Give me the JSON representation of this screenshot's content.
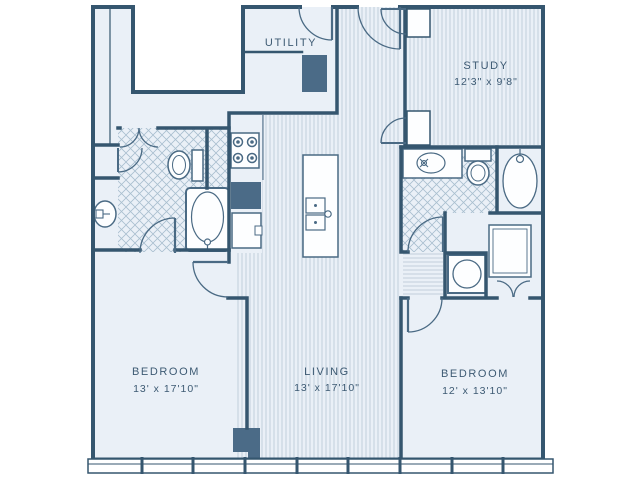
{
  "plan": {
    "rooms": {
      "utility": {
        "name": "UTILITY"
      },
      "study": {
        "name": "STUDY",
        "dims": "12'3\" x 9'8\""
      },
      "bedroom_left": {
        "name": "BEDROOM",
        "dims": "13' x 17'10\""
      },
      "living": {
        "name": "LIVING",
        "dims": "13' x 17'10\""
      },
      "bedroom_right": {
        "name": "BEDROOM",
        "dims": "12' x 13'10\""
      }
    },
    "colors": {
      "background": "#ffffff",
      "wall": "#35566f",
      "floor": "#eaf0f7",
      "accent_block": "#4b6b87",
      "fixture_outline": "#4a6a84",
      "label_text": "#3d5a73",
      "plank_line": "#bccbd8",
      "tile_line": "#a9bfcf"
    },
    "fixtures": [
      "stove",
      "refrigerator",
      "kitchen-sink",
      "island-double-sink",
      "toilet",
      "bathtub",
      "pedestal-sink",
      "vanity-sink",
      "washer-dryer",
      "water-heater",
      "wardrobe",
      "entry-door",
      "windows"
    ]
  }
}
